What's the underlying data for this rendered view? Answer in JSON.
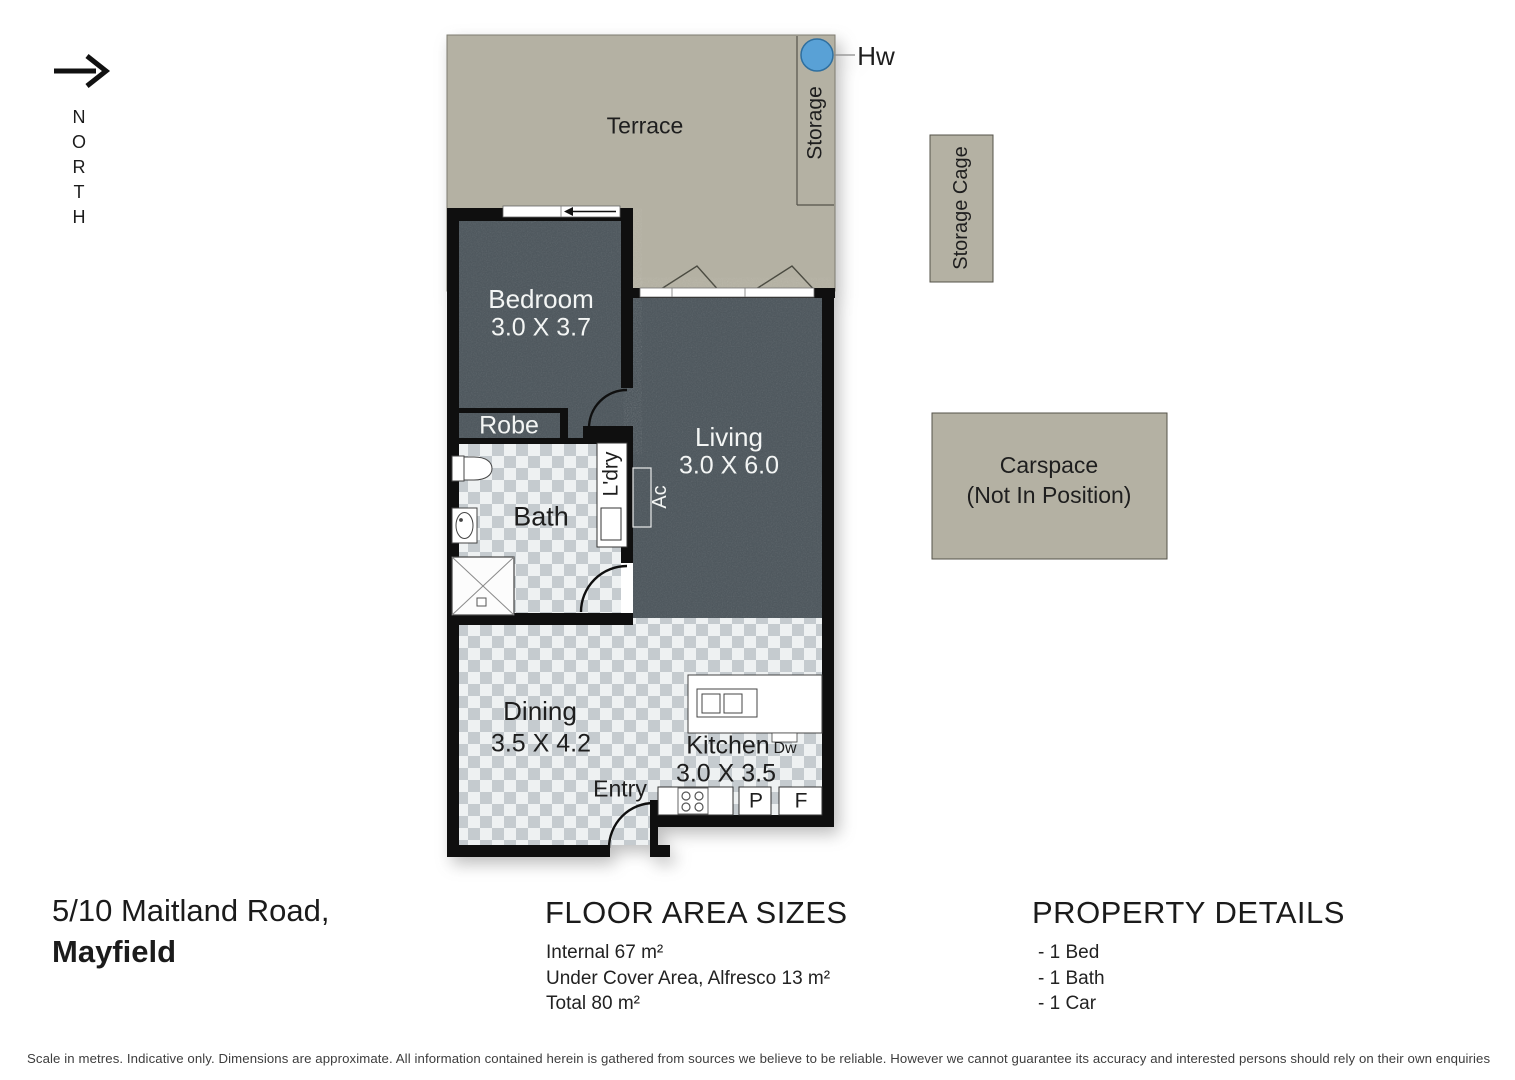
{
  "compass": {
    "letters": [
      "N",
      "O",
      "R",
      "T",
      "H"
    ]
  },
  "outdoor": {
    "terrace": "Terrace",
    "storage": "Storage",
    "hw": "Hw",
    "storage_cage": "Storage Cage",
    "carspace_line1": "Carspace",
    "carspace_line2": "(Not In Position)"
  },
  "rooms": {
    "bedroom_name": "Bedroom",
    "bedroom_dims": "3.0 X 3.7",
    "robe": "Robe",
    "bath": "Bath",
    "ldry": "L'dry",
    "ac": "Ac",
    "living_name": "Living",
    "living_dims": "3.0 X 6.0",
    "dining_name": "Dining",
    "dining_dims": "3.5 X 4.2",
    "kitchen_name": "Kitchen",
    "kitchen_dims": "3.0 X 3.5",
    "entry": "Entry",
    "dw": "Dw",
    "pantry": "P",
    "fridge": "F"
  },
  "footer": {
    "address_line1": "5/10 Maitland Road,",
    "address_line2": "Mayfield",
    "floor_area_title": "FLOOR AREA SIZES",
    "floor_area_lines": [
      "Internal 67 m²",
      "Under Cover Area, Alfresco 13 m²",
      "Total 80 m²"
    ],
    "property_title": "PROPERTY DETAILS",
    "property_items": [
      "- 1 Bed",
      "- 1 Bath",
      "- 1 Car"
    ],
    "disclaimer": "Scale in metres. Indicative only. Dimensions are approximate. All information contained herein is gathered from sources we believe to be reliable. However we cannot guarantee its accuracy and interested persons should rely on their own enquiries"
  },
  "colors": {
    "outdoor_fill": "#b4b1a3",
    "room_dark": "#4f585e",
    "checker_dark": "#c5cbcf",
    "checker_light": "#eef1f2",
    "wall": "#0f0f0f",
    "hw_blue": "#59a1d6"
  }
}
